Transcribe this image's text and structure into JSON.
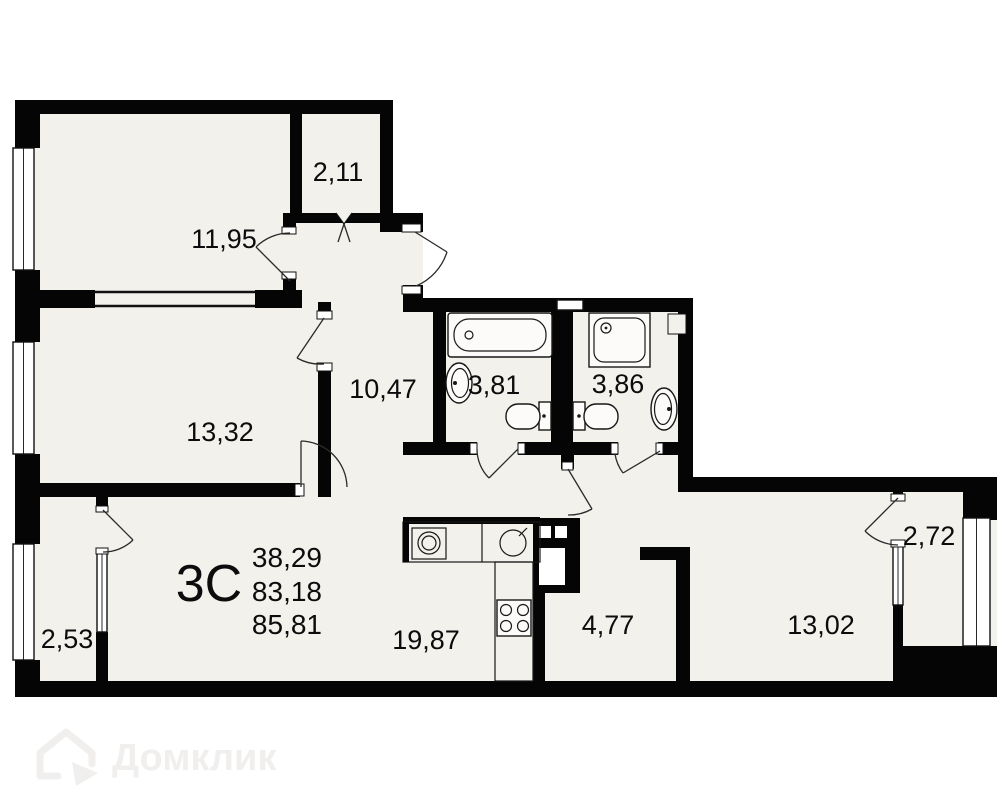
{
  "plan": {
    "type_label": "3С",
    "summary": [
      "38,29",
      "83,18",
      "85,81"
    ],
    "rooms": [
      {
        "id": "wardrobe",
        "label": "2,11"
      },
      {
        "id": "bedroom-1",
        "label": "11,95"
      },
      {
        "id": "bedroom-2",
        "label": "13,32"
      },
      {
        "id": "hallway",
        "label": "10,47"
      },
      {
        "id": "bathroom-1",
        "label": "3,81"
      },
      {
        "id": "bathroom-2",
        "label": "3,86"
      },
      {
        "id": "balcony-left",
        "label": "2,53"
      },
      {
        "id": "kitchen-living",
        "label": "19,87"
      },
      {
        "id": "corridor",
        "label": "4,77"
      },
      {
        "id": "bedroom-3",
        "label": "13,02"
      },
      {
        "id": "balcony-right",
        "label": "2,72"
      }
    ],
    "watermark": "Домклик",
    "colors": {
      "wall": "#050505",
      "floor": "#f3f1ec",
      "background": "#ffffff",
      "watermark": "#f1efed"
    }
  }
}
